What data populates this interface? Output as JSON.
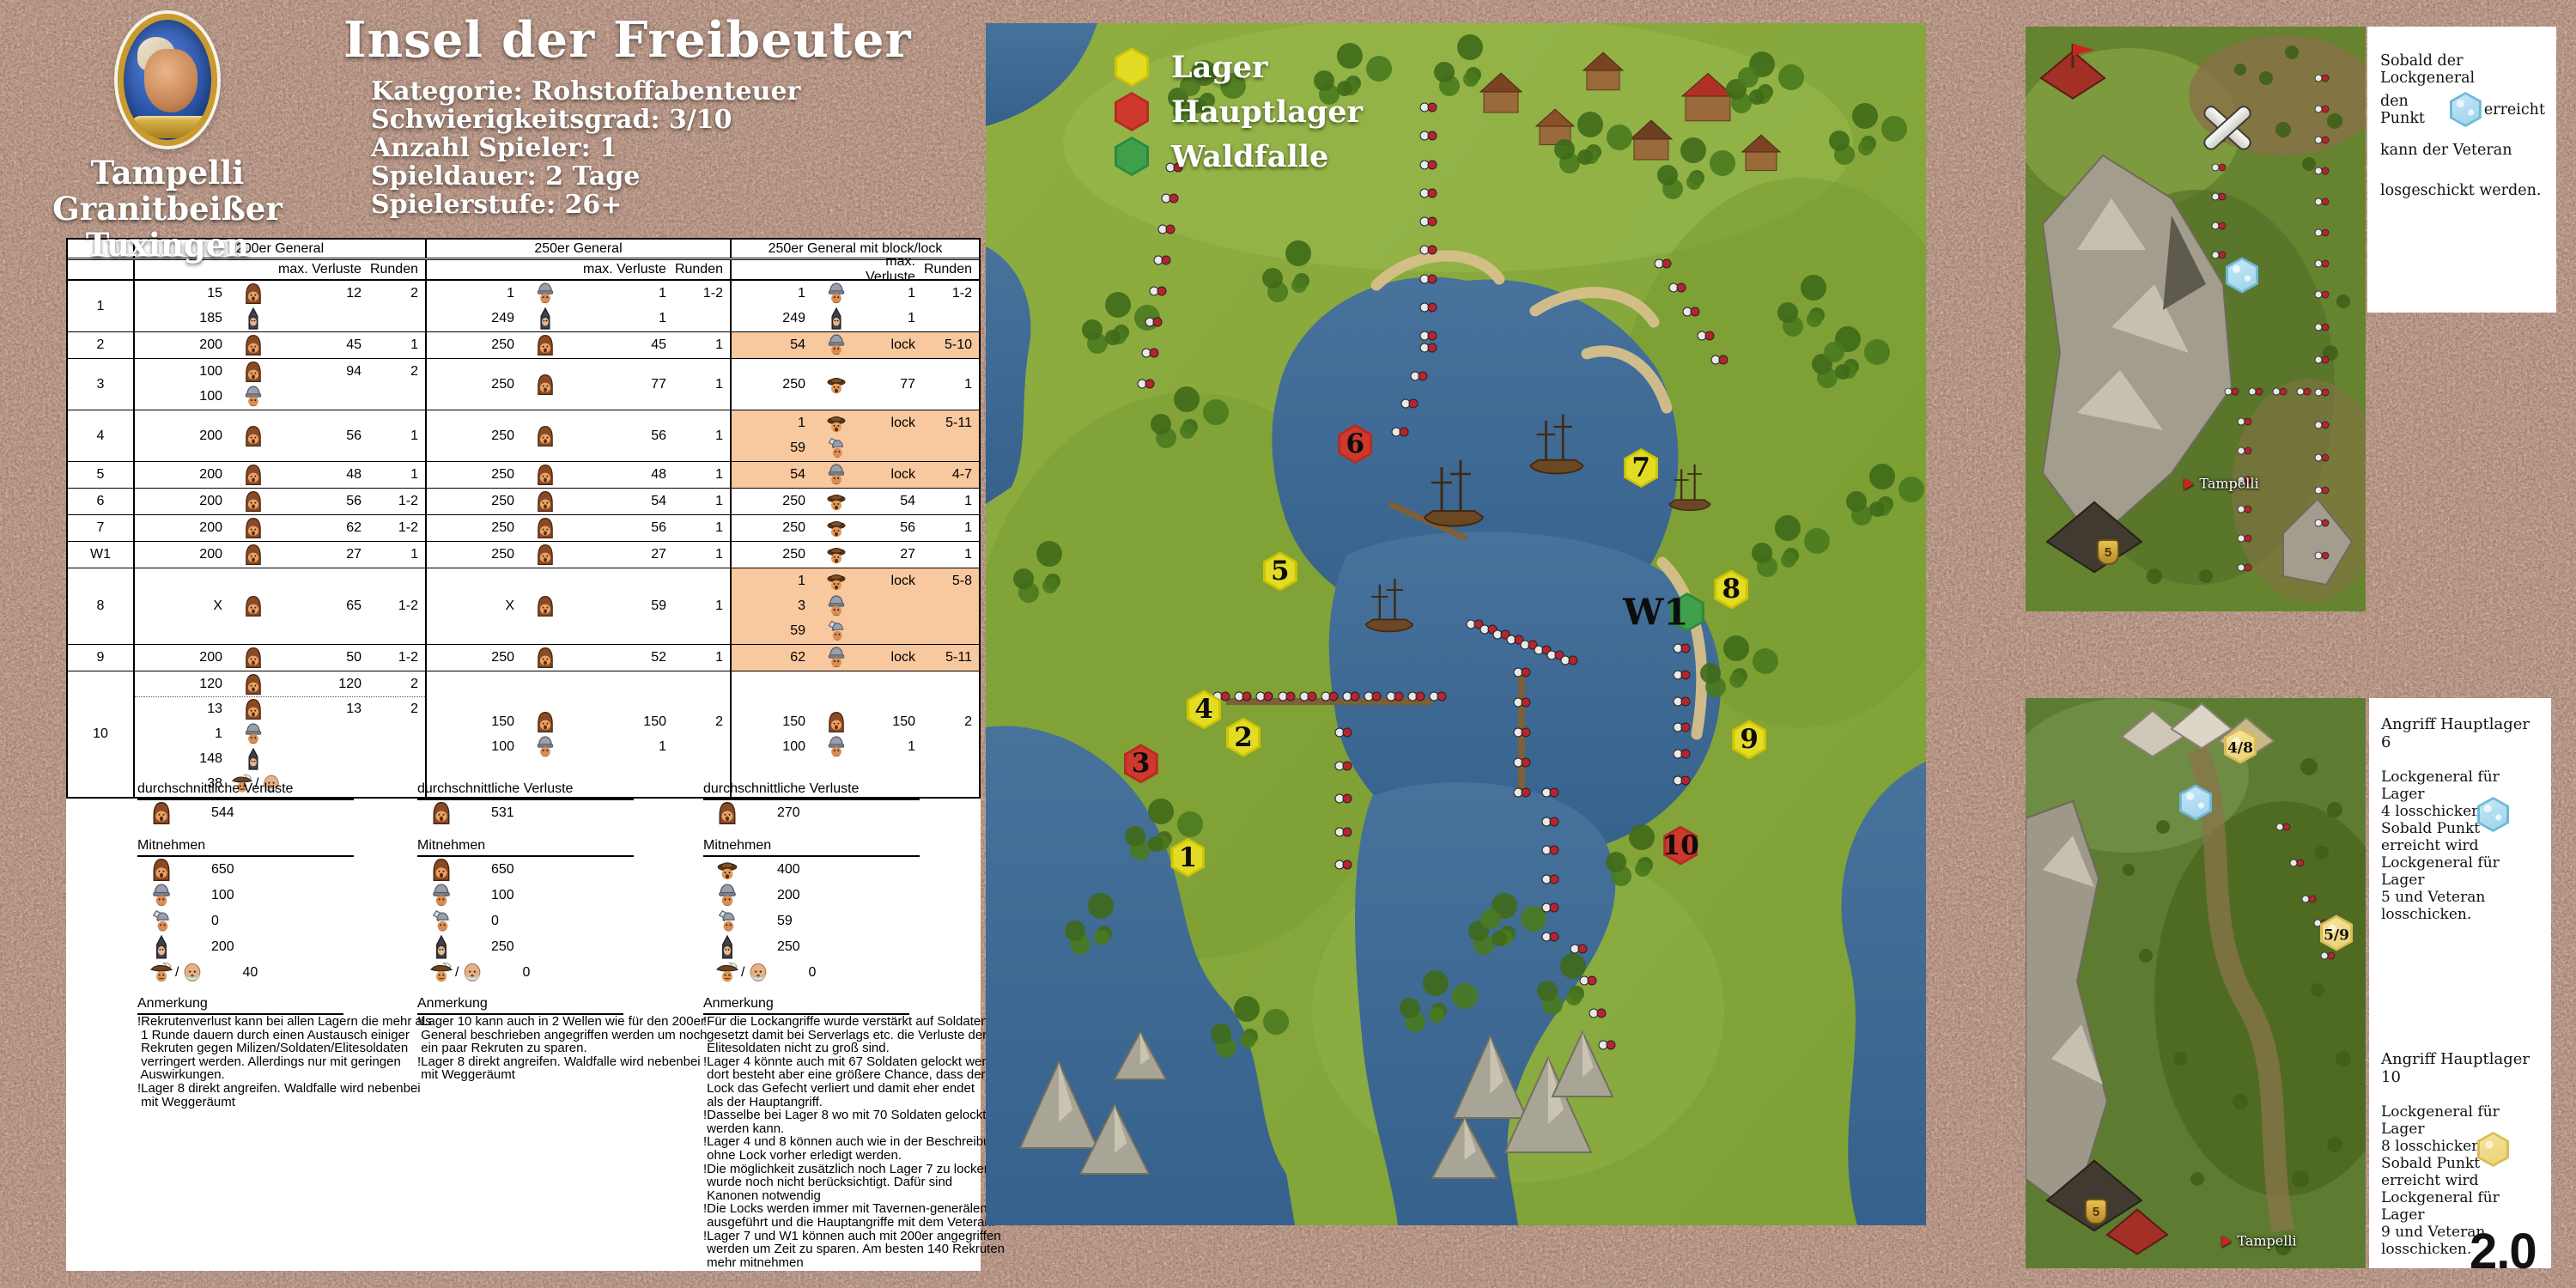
{
  "version": "2.0",
  "profile": {
    "name": [
      "Tampelli",
      "Granitbeißer",
      "Tuxingen"
    ]
  },
  "header": {
    "title": "Insel der Freibeuter",
    "details": [
      "Kategorie: Rohstoffabenteuer",
      "Schwierigkeitsgrad: 3/10",
      "Anzahl Spieler: 1",
      "Spieldauer: 2 Tage",
      "Spielerstufe: 26+"
    ]
  },
  "legend": {
    "items": [
      {
        "label": "Lager",
        "type": "camp",
        "color": "#e8dc3c"
      },
      {
        "label": "Hauptlager",
        "type": "main",
        "color": "#cc3a2e"
      },
      {
        "label": "Waldfalle",
        "type": "trap",
        "color": "#4aac56"
      }
    ]
  },
  "colors": {
    "highlight": "#f8c89e",
    "water": "#3f6d98",
    "land": "#86a93c",
    "camp": "#e8dc3c",
    "main_camp": "#cc3a2e",
    "forest_trap": "#4aac56",
    "ice_point": "#9ed3ec",
    "gold_point": "#f0dc8e"
  },
  "icons": {
    "recruit": "recruit-icon",
    "militia": "militia-icon",
    "soldier": "soldier-icon",
    "elite": "elite-soldier-icon",
    "axe": "axe-soldier-icon",
    "cavkan": "cavalry-icon / cannoneer-icon"
  },
  "table": {
    "groups": [
      "200er General",
      "250er General",
      "250er General mit block/lock"
    ],
    "subheaders": {
      "verluste": "max. Verluste",
      "runden": "Runden"
    },
    "rows": [
      {
        "label": "1",
        "cols": [
          {
            "lines": [
              {
                "count": "15",
                "unit": "recruit",
                "verluste": "12",
                "runden": "2"
              },
              {
                "count": "185",
                "unit": "militia"
              }
            ]
          },
          {
            "lines": [
              {
                "count": "1",
                "unit": "soldier",
                "verluste": "1",
                "runden": "1-2"
              },
              {
                "count": "249",
                "unit": "militia",
                "verluste": "1"
              }
            ]
          },
          {
            "lines": [
              {
                "count": "1",
                "unit": "soldier",
                "verluste": "1",
                "runden": "1-2"
              },
              {
                "count": "249",
                "unit": "militia",
                "verluste": "1"
              }
            ]
          }
        ]
      },
      {
        "label": "2",
        "cols": [
          {
            "lines": [
              {
                "count": "200",
                "unit": "recruit",
                "verluste": "45",
                "runden": "1"
              }
            ]
          },
          {
            "lines": [
              {
                "count": "250",
                "unit": "recruit",
                "verluste": "45",
                "runden": "1"
              }
            ]
          },
          {
            "highlight": true,
            "lines": [
              {
                "count": "54",
                "unit": "soldier",
                "verluste": "lock",
                "runden": "5-10"
              }
            ]
          }
        ]
      },
      {
        "label": "3",
        "cols": [
          {
            "lines": [
              {
                "count": "100",
                "unit": "recruit",
                "verluste": "94",
                "runden": "2"
              },
              {
                "count": "100",
                "unit": "soldier"
              }
            ]
          },
          {
            "lines": [
              {
                "count": "250",
                "unit": "recruit",
                "verluste": "77",
                "runden": "1"
              }
            ]
          },
          {
            "lines": [
              {
                "count": "250",
                "unit": "elite",
                "verluste": "77",
                "runden": "1"
              }
            ]
          }
        ]
      },
      {
        "label": "4",
        "cols": [
          {
            "lines": [
              {
                "count": "200",
                "unit": "recruit",
                "verluste": "56",
                "runden": "1"
              }
            ]
          },
          {
            "lines": [
              {
                "count": "250",
                "unit": "recruit",
                "verluste": "56",
                "runden": "1"
              }
            ]
          },
          {
            "highlight": true,
            "lines": [
              {
                "count": "1",
                "unit": "elite",
                "verluste": "lock",
                "runden": "5-11"
              },
              {
                "count": "59",
                "unit": "axe"
              }
            ]
          }
        ]
      },
      {
        "label": "5",
        "cols": [
          {
            "lines": [
              {
                "count": "200",
                "unit": "recruit",
                "verluste": "48",
                "runden": "1"
              }
            ]
          },
          {
            "lines": [
              {
                "count": "250",
                "unit": "recruit",
                "verluste": "48",
                "runden": "1"
              }
            ]
          },
          {
            "highlight": true,
            "lines": [
              {
                "count": "54",
                "unit": "soldier",
                "verluste": "lock",
                "runden": "4-7"
              }
            ]
          }
        ]
      },
      {
        "label": "6",
        "cols": [
          {
            "lines": [
              {
                "count": "200",
                "unit": "recruit",
                "verluste": "56",
                "runden": "1-2"
              }
            ]
          },
          {
            "lines": [
              {
                "count": "250",
                "unit": "recruit",
                "verluste": "54",
                "runden": "1"
              }
            ]
          },
          {
            "lines": [
              {
                "count": "250",
                "unit": "elite",
                "verluste": "54",
                "runden": "1"
              }
            ]
          }
        ]
      },
      {
        "label": "7",
        "cols": [
          {
            "lines": [
              {
                "count": "200",
                "unit": "recruit",
                "verluste": "62",
                "runden": "1-2"
              }
            ]
          },
          {
            "lines": [
              {
                "count": "250",
                "unit": "recruit",
                "verluste": "56",
                "runden": "1"
              }
            ]
          },
          {
            "lines": [
              {
                "count": "250",
                "unit": "elite",
                "verluste": "56",
                "runden": "1"
              }
            ]
          }
        ]
      },
      {
        "label": "W1",
        "cols": [
          {
            "lines": [
              {
                "count": "200",
                "unit": "recruit",
                "verluste": "27",
                "runden": "1"
              }
            ]
          },
          {
            "lines": [
              {
                "count": "250",
                "unit": "recruit",
                "verluste": "27",
                "runden": "1"
              }
            ]
          },
          {
            "lines": [
              {
                "count": "250",
                "unit": "elite",
                "verluste": "27",
                "runden": "1"
              }
            ]
          }
        ]
      },
      {
        "label": "8",
        "cols": [
          {
            "lines": [
              {
                "count": "X",
                "unit": "recruit",
                "verluste": "65",
                "runden": "1-2"
              }
            ]
          },
          {
            "lines": [
              {
                "count": "X",
                "unit": "recruit",
                "verluste": "59",
                "runden": "1"
              }
            ]
          },
          {
            "highlight": true,
            "lines": [
              {
                "count": "1",
                "unit": "elite",
                "verluste": "lock",
                "runden": "5-8"
              },
              {
                "count": "3",
                "unit": "soldier"
              },
              {
                "count": "59",
                "unit": "axe"
              }
            ]
          }
        ]
      },
      {
        "label": "9",
        "cols": [
          {
            "lines": [
              {
                "count": "200",
                "unit": "recruit",
                "verluste": "50",
                "runden": "1-2"
              }
            ]
          },
          {
            "lines": [
              {
                "count": "250",
                "unit": "recruit",
                "verluste": "52",
                "runden": "1"
              }
            ]
          },
          {
            "highlight": true,
            "lines": [
              {
                "count": "62",
                "unit": "soldier",
                "verluste": "lock",
                "runden": "5-11"
              }
            ]
          }
        ]
      },
      {
        "label": "10",
        "cols": [
          {
            "lines": [
              {
                "count": "120",
                "unit": "recruit",
                "verluste": "120",
                "runden": "2",
                "dotted_after": true
              },
              {
                "count": "13",
                "unit": "recruit",
                "verluste": "13",
                "runden": "2"
              },
              {
                "count": "1",
                "unit": "soldier"
              },
              {
                "count": "148",
                "unit": "militia"
              },
              {
                "count": "38",
                "unit": "cavkan"
              }
            ]
          },
          {
            "lines": [
              {
                "count": "150",
                "unit": "recruit",
                "verluste": "150",
                "runden": "2"
              },
              {
                "count": "100",
                "unit": "soldier",
                "verluste": "1"
              }
            ]
          },
          {
            "lines": [
              {
                "count": "150",
                "unit": "recruit",
                "verluste": "150",
                "runden": "2"
              },
              {
                "count": "100",
                "unit": "soldier",
                "verluste": "1"
              }
            ]
          }
        ]
      }
    ],
    "summary": {
      "verluste_title": "durchschnittliche Verluste",
      "mitnehmen_title": "Mitnehmen",
      "anmerkung_title": "Anmerkung",
      "columns": [
        {
          "avg": {
            "unit": "recruit",
            "value": "544"
          },
          "mitnehmen": [
            {
              "unit": "recruit",
              "value": "650"
            },
            {
              "unit": "soldier",
              "value": "100"
            },
            {
              "unit": "axe",
              "value": "0"
            },
            {
              "unit": "militia",
              "value": "200"
            },
            {
              "unit": "cavkan",
              "value": "40"
            }
          ],
          "anmerkung": [
            "!Rekrutenverlust kann bei allen Lagern die mehr als",
            " 1 Runde dauern durch einen Austausch einiger",
            " Rekruten gegen Milizen/Soldaten/Elitesoldaten",
            " verringert werden. Allerdings nur mit geringen",
            " Auswirkungen.",
            "!Lager 8 direkt angreifen. Waldfalle wird nebenbei",
            " mit Weggeräumt"
          ]
        },
        {
          "avg": {
            "unit": "recruit",
            "value": "531"
          },
          "mitnehmen": [
            {
              "unit": "recruit",
              "value": "650"
            },
            {
              "unit": "soldier",
              "value": "100"
            },
            {
              "unit": "axe",
              "value": "0"
            },
            {
              "unit": "militia",
              "value": "250"
            },
            {
              "unit": "cavkan",
              "value": "0"
            }
          ],
          "anmerkung": [
            "!Lager 10 kann auch in 2 Wellen wie für den 200er",
            " General beschrieben angegriffen werden um noch",
            " ein paar Rekruten zu sparen.",
            "!Lager 8 direkt angreifen. Waldfalle wird nebenbei",
            " mit Weggeräumt"
          ]
        },
        {
          "avg": {
            "unit": "recruit",
            "value": "270"
          },
          "mitnehmen": [
            {
              "unit": "elite",
              "value": "400"
            },
            {
              "unit": "soldier",
              "value": "200"
            },
            {
              "unit": "axe",
              "value": "59"
            },
            {
              "unit": "militia",
              "value": "250"
            },
            {
              "unit": "cavkan",
              "value": "0"
            }
          ],
          "anmerkung": [
            "!Für die Lockangriffe wurde verstärkt auf Soldaten",
            " gesetzt damit bei Serverlags etc. die Verluste der",
            " Elitesoldaten nicht zu groß sind.",
            "!Lager 4 könnte auch mit 67 Soldaten gelockt werden",
            " dort besteht aber eine größere Chance, dass der",
            " Lock das Gefecht verliert und damit eher endet",
            " als der Hauptangriff.",
            "!Dasselbe bei Lager 8 wo mit 70 Soldaten gelockt",
            " werden kann.",
            "!Lager 4 und 8 können auch wie in der Beschreibung",
            " ohne Lock vorher erledigt werden.",
            "!Die möglichkeit zusätzlich noch Lager 7 zu locken",
            " wurde noch nicht berücksichtigt. Dafür sind",
            " Kanonen notwendig",
            "!Die Locks werden immer mit Tavernen-generälen",
            " ausgeführt und die Hauptangriffe mit dem Veteran.",
            "!Lager 7 und W1 können auch mit 200er angegriffen",
            " werden um Zeit zu sparen. Am besten 140 Rekruten",
            " mehr mitnehmen"
          ]
        }
      ]
    }
  },
  "map": {
    "markers": [
      {
        "id": "1",
        "type": "camp",
        "x": 21.5,
        "y": 69.4
      },
      {
        "id": "2",
        "type": "camp",
        "x": 27.4,
        "y": 59.4
      },
      {
        "id": "3",
        "type": "main",
        "x": 16.5,
        "y": 61.6
      },
      {
        "id": "4",
        "type": "camp",
        "x": 23.2,
        "y": 57.1
      },
      {
        "id": "5",
        "type": "camp",
        "x": 31.3,
        "y": 45.6
      },
      {
        "id": "6",
        "type": "main",
        "x": 39.3,
        "y": 35.0
      },
      {
        "id": "7",
        "type": "camp",
        "x": 69.7,
        "y": 37.0
      },
      {
        "id": "8",
        "type": "camp",
        "x": 79.3,
        "y": 47.1
      },
      {
        "id": "9",
        "type": "camp",
        "x": 81.2,
        "y": 59.6
      },
      {
        "id": "10",
        "type": "main",
        "x": 73.9,
        "y": 68.4
      },
      {
        "id": "W1",
        "type": "trap",
        "x": 74.6,
        "y": 49.0
      }
    ]
  },
  "notes": {
    "top": {
      "l1": "Sobald der Lockgeneral",
      "l2_pre": "den Punkt",
      "l2_icon": "ice-hex-icon",
      "l2_post": "erreicht",
      "l3": "kann der Veteran",
      "l4": "losgeschickt werden."
    },
    "bottom": {
      "s1": {
        "title": "Angriff Hauptlager 6",
        "hex": "ice",
        "l1": "Lockgeneral für Lager",
        "l2": "4 losschicken.",
        "l3": "Sobald Punkt",
        "l4": "erreicht wird",
        "l5": "Lockgeneral für Lager",
        "l6": "5 und Veteran",
        "l7": "losschicken."
      },
      "s2": {
        "title": "Angriff Hauptlager 10",
        "hex": "gold",
        "l1": "Lockgeneral für Lager",
        "l2": "8 losschicken.",
        "l3": "Sobald Punkt",
        "l4": "erreicht wird",
        "l5": "Lockgeneral für Lager",
        "l6": "9 und Veteran",
        "l7": "losschicken."
      }
    }
  },
  "minimaps": {
    "top": {
      "player": "Tampelli",
      "shield": "5"
    },
    "bottom": {
      "player": "Tampelli",
      "shield": "5",
      "hex1": "4/8",
      "hex2": "5/9"
    }
  }
}
